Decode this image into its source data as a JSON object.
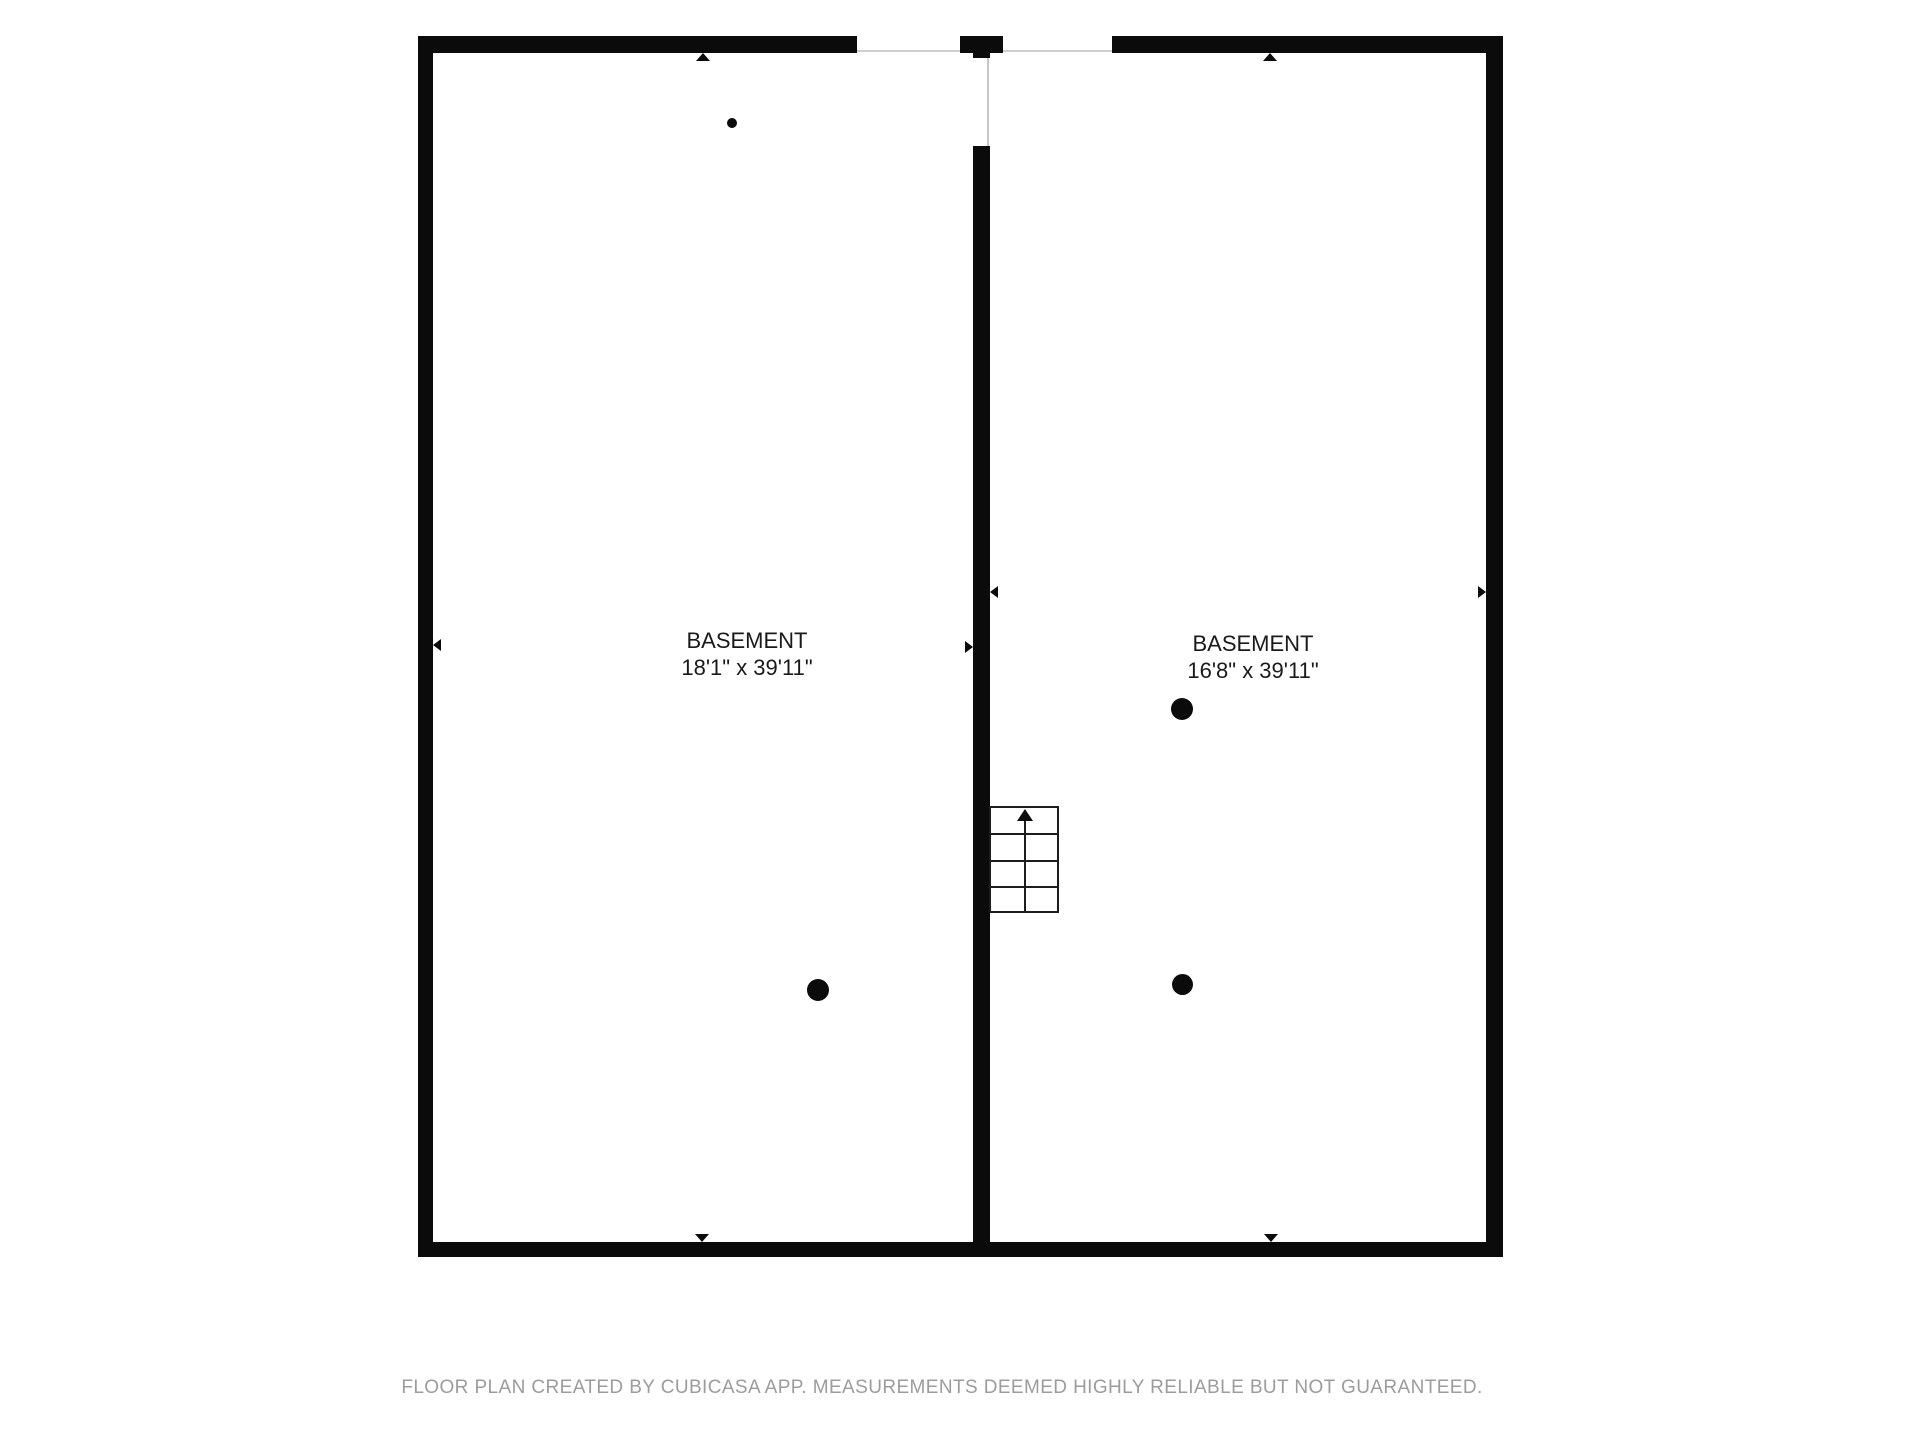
{
  "floor_plan": {
    "title": "Basement floor plan",
    "rooms": [
      {
        "id": "basement-left",
        "name": "BASEMENT",
        "dimensions": "18'1\" x 39'11\""
      },
      {
        "id": "basement-right",
        "name": "BASEMENT",
        "dimensions": "16'8\" x 39'11\""
      }
    ],
    "features": {
      "staircase": "stairs with up-direction arrow, 4 treads, against center dividing wall",
      "support_columns": 3,
      "point_markers": 1,
      "dimension_arrows": 8
    },
    "colors": {
      "wall": "#0b0b0b",
      "background": "#ffffff",
      "label_text": "#1a1a1a",
      "footer_text": "#9c9c9c",
      "opening_line": "#cfcfcf"
    }
  },
  "footer": {
    "disclaimer": "FLOOR PLAN CREATED BY CUBICASA APP. MEASUREMENTS DEEMED HIGHLY RELIABLE BUT NOT GUARANTEED."
  }
}
